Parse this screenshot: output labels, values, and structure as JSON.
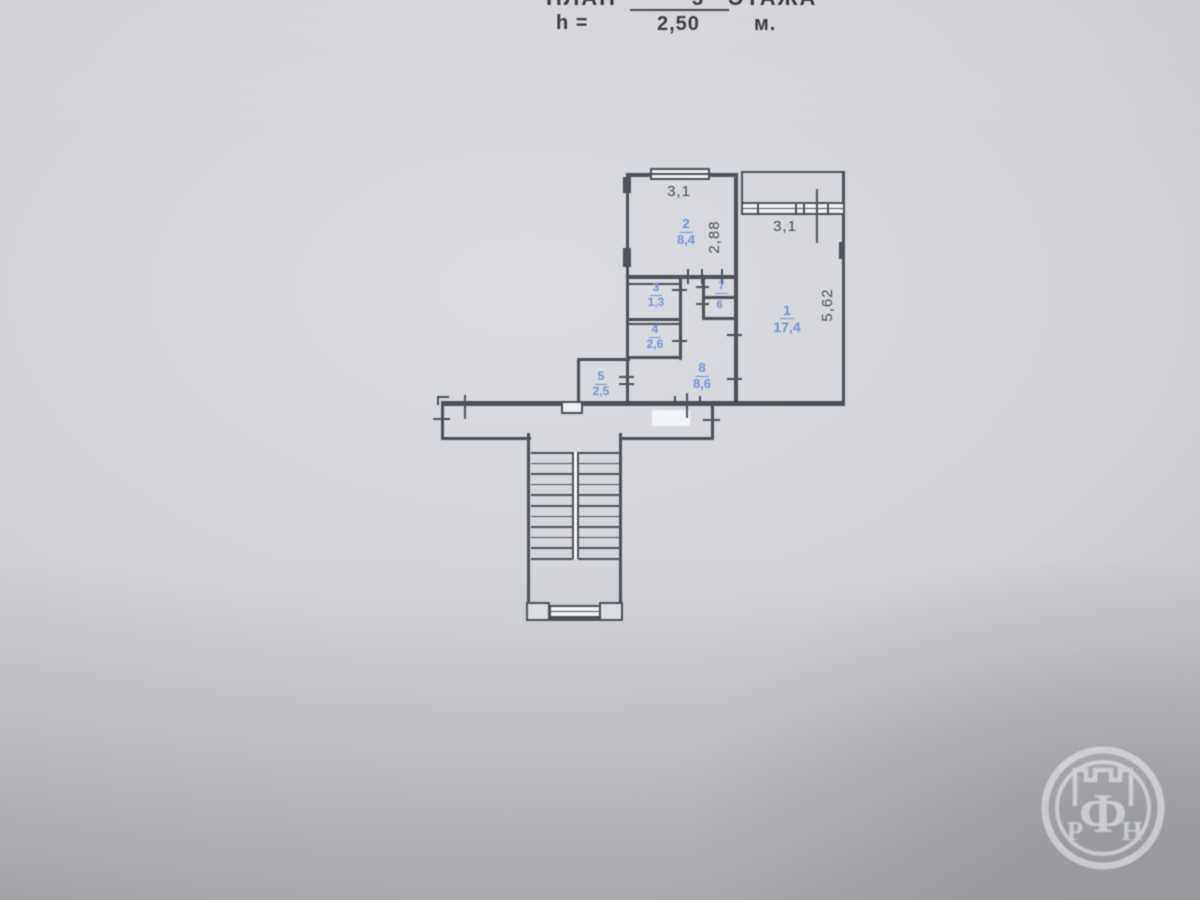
{
  "header": {
    "title_left": "ПЛАН",
    "floor_number": "3",
    "title_right": "ЭТАЖА",
    "height_label": "h =",
    "height_value": "2,50",
    "height_unit": "м."
  },
  "plan": {
    "rooms": [
      {
        "number": "1",
        "area": "17,4"
      },
      {
        "number": "2",
        "area": "8,4"
      },
      {
        "number": "3",
        "area": "1,3"
      },
      {
        "number": "4",
        "area": "2,6"
      },
      {
        "number": "5",
        "area": "2,5"
      },
      {
        "number": "6",
        "area": ""
      },
      {
        "number": "7",
        "area": ""
      },
      {
        "number": "8",
        "area": "8,6"
      }
    ],
    "dimensions": {
      "kitchen_width": "3,1",
      "kitchen_depth": "2,88",
      "loggia_width": "3,1",
      "room1_depth": "5,62"
    },
    "colors": {
      "line": "#4d5058",
      "room_label": "#7595d2"
    }
  },
  "watermark": {
    "letters": [
      "Р",
      "Ф",
      "Н"
    ]
  }
}
